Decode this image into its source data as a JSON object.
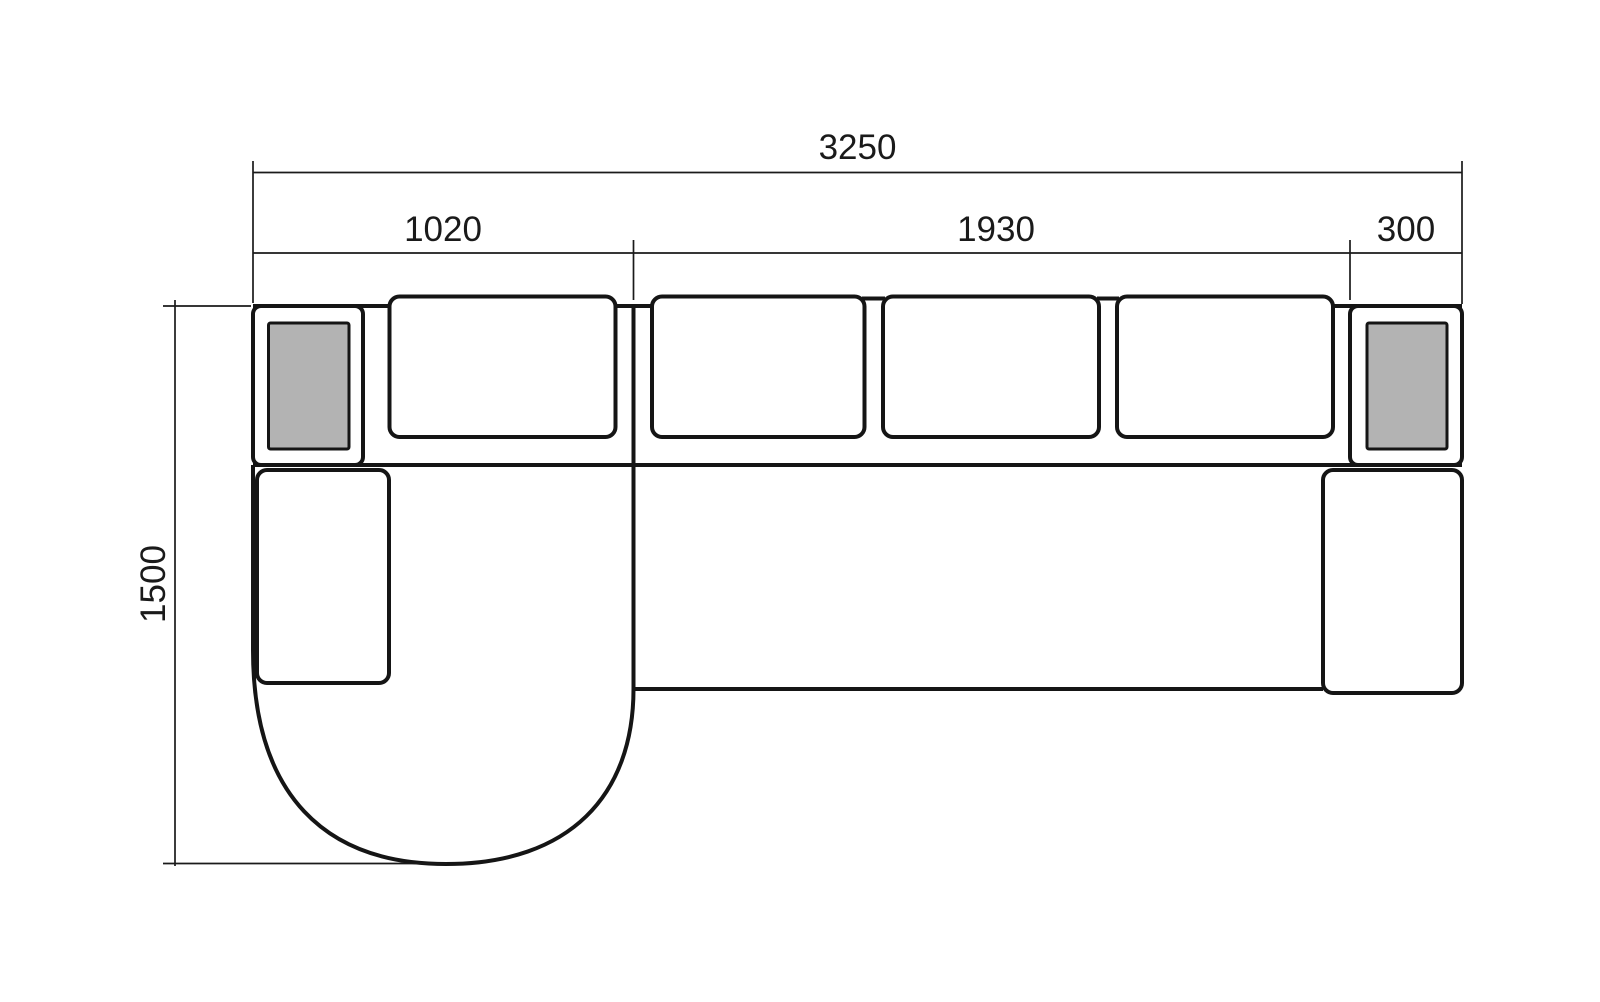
{
  "drawing": {
    "dimensions": {
      "overall_width": "3250",
      "chaise_module_width": "1020",
      "seat_module_width": "1930",
      "arm_module_width": "300",
      "overall_depth": "1500"
    },
    "colors": {
      "line": "#151515",
      "armrest_pad_fill": "#b3b3b3",
      "background": "#ffffff"
    }
  }
}
